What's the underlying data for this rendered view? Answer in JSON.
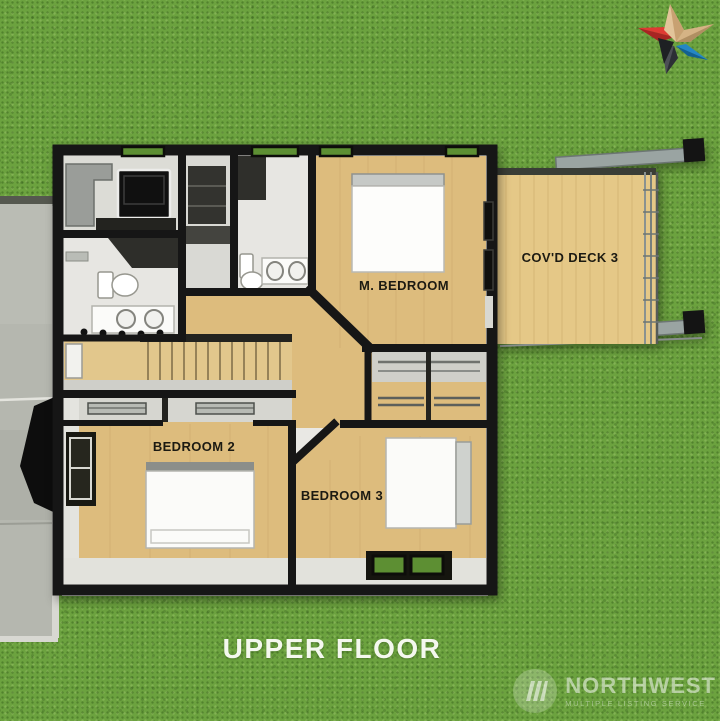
{
  "scene": {
    "title": "UPPER FLOOR",
    "colors": {
      "grass": "#6ca23f",
      "wall": "#161616",
      "wood": "#ddbc7d",
      "wood_light": "#e4ca8e",
      "deck": "#e5c887",
      "bath": "#e7e6e2",
      "concrete": "#b5b7af",
      "label_ink": "#1c1a12"
    }
  },
  "floorplan": {
    "rooms": [
      {
        "id": "master-bedroom",
        "label": "M. BEDROOM"
      },
      {
        "id": "covered-deck",
        "label": "COV'D DECK 3"
      },
      {
        "id": "bedroom-2",
        "label": "BEDROOM 2"
      },
      {
        "id": "bedroom-3",
        "label": "BEDROOM 3"
      }
    ]
  },
  "branding": {
    "star_logo_colors": {
      "tan": "#d8b88c",
      "tan_dark": "#b5905f",
      "red": "#d8312f",
      "red_dark": "#a82423",
      "blue": "#2486c4",
      "charcoal": "#4c4f55"
    },
    "watermark": {
      "name": "NORTHWEST",
      "tagline": "MULTIPLE LISTING SERVICE"
    }
  }
}
